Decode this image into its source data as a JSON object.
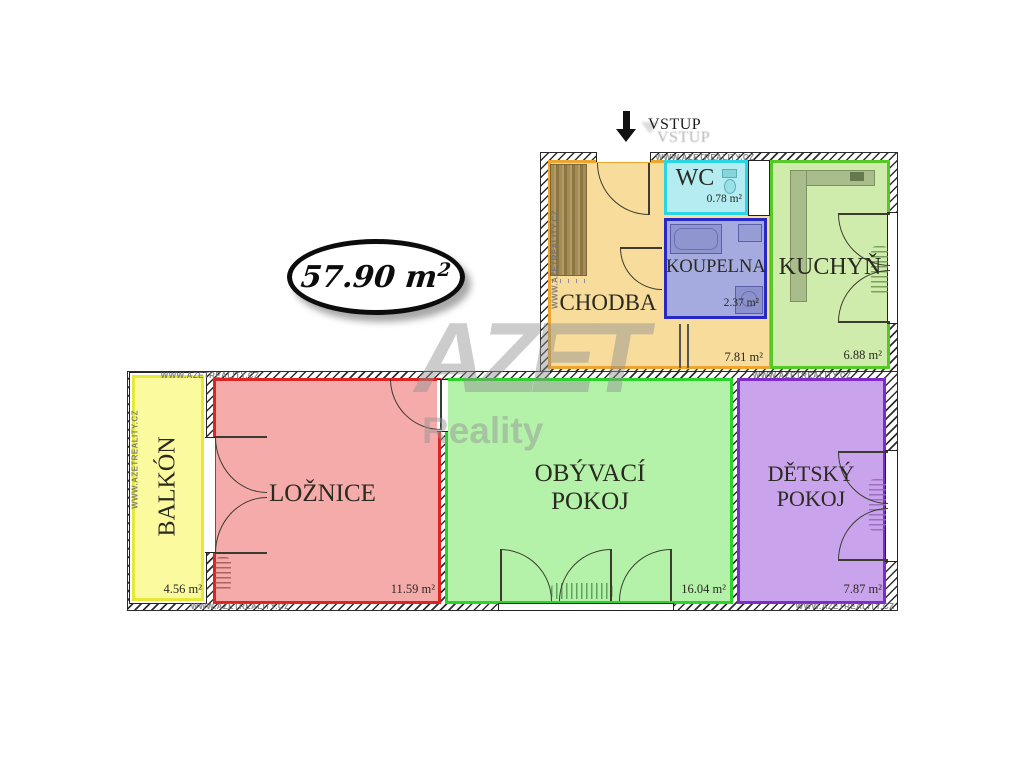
{
  "badge": {
    "area_value": "57.90 m",
    "area_sup": "2"
  },
  "entrance": {
    "label": "VSTUP"
  },
  "watermark": {
    "brand": "AZET",
    "subtitle": "Reality",
    "site": "WWW.AZETREALITY.CZ"
  },
  "rooms": [
    {
      "id": "chodba",
      "name": "CHODBA",
      "area": "7.81 m²",
      "fill": "#F8DC9C",
      "border": "#EDA52F"
    },
    {
      "id": "wc",
      "name": "WC",
      "area": "0.78 m²",
      "fill": "#B4ECF2",
      "border": "#28D6E6"
    },
    {
      "id": "koupelna",
      "name": "KOUPELNA",
      "area": "2.37 m²",
      "fill": "#A5ABDE",
      "border": "#2828C6"
    },
    {
      "id": "kuchyn",
      "name": "KUCHYŇ",
      "area": "6.88 m²",
      "fill": "#D0ECAC",
      "border": "#55C926"
    },
    {
      "id": "balkon",
      "name": "BALKÓN",
      "area": "4.56 m²",
      "fill": "#FBFA9F",
      "border": "#E8E838"
    },
    {
      "id": "loznice",
      "name": "LOŽNICE",
      "area": "11.59 m²",
      "fill": "#F6ABAB",
      "border": "#DD2424"
    },
    {
      "id": "obyvaci",
      "name": "OBÝVACÍ POKOJ",
      "area": "16.04 m²",
      "fill": "#B4F2AA",
      "border": "#2BD32B"
    },
    {
      "id": "detsky",
      "name": "DĚTSKÝ POKOJ",
      "area": "7.87 m²",
      "fill": "#C9A4EC",
      "border": "#7F2BCB"
    }
  ]
}
